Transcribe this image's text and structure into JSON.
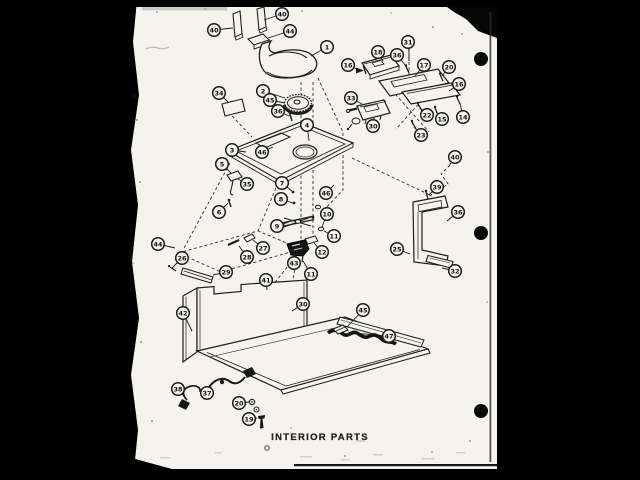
{
  "canvas": {
    "background_color": "#000000",
    "paper_color": "#f5f3ef",
    "ink_color": "#1c1c1c"
  },
  "diagram": {
    "title": "INTERIOR PARTS",
    "callouts": [
      {
        "n": "40",
        "x": 214,
        "y": 30,
        "tx": 233,
        "ty": 28
      },
      {
        "n": "40",
        "x": 282,
        "y": 14,
        "tx": 264,
        "ty": 20
      },
      {
        "n": "44",
        "x": 290,
        "y": 31,
        "tx": 268,
        "ty": 38
      },
      {
        "n": "1",
        "x": 327,
        "y": 47,
        "tx": 311,
        "ty": 56
      },
      {
        "n": "34",
        "x": 219,
        "y": 93,
        "tx": 228,
        "ty": 102
      },
      {
        "n": "2",
        "x": 263,
        "y": 91,
        "tx": 285,
        "ty": 98
      },
      {
        "n": "45",
        "x": 270,
        "y": 100,
        "tx": 285,
        "ty": 103
      },
      {
        "n": "36",
        "x": 278,
        "y": 111,
        "tx": 289,
        "ty": 116
      },
      {
        "n": "4",
        "x": 307,
        "y": 125,
        "tx": 309,
        "ty": 141
      },
      {
        "n": "3",
        "x": 232,
        "y": 150,
        "tx": 246,
        "ty": 152
      },
      {
        "n": "46",
        "x": 262,
        "y": 152,
        "tx": 273,
        "ty": 147
      },
      {
        "n": "5",
        "x": 222,
        "y": 164,
        "tx": 231,
        "ty": 173
      },
      {
        "n": "35",
        "x": 247,
        "y": 184,
        "tx": 238,
        "ty": 179
      },
      {
        "n": "6",
        "x": 219,
        "y": 212,
        "tx": 228,
        "ty": 203
      },
      {
        "n": "7",
        "x": 282,
        "y": 183,
        "tx": 292,
        "ty": 191
      },
      {
        "n": "8",
        "x": 281,
        "y": 199,
        "tx": 293,
        "ty": 203
      },
      {
        "n": "46",
        "x": 326,
        "y": 193,
        "tx": 334,
        "ty": 185
      },
      {
        "n": "9",
        "x": 277,
        "y": 226,
        "tx": 289,
        "ty": 222
      },
      {
        "n": "10",
        "x": 327,
        "y": 214,
        "tx": 322,
        "ty": 227
      },
      {
        "n": "11",
        "x": 334,
        "y": 236,
        "tx": 324,
        "ty": 231
      },
      {
        "n": "12",
        "x": 322,
        "y": 252,
        "tx": 314,
        "ty": 243
      },
      {
        "n": "43",
        "x": 294,
        "y": 263,
        "tx": 296,
        "ty": 257
      },
      {
        "n": "11",
        "x": 311,
        "y": 274,
        "tx": 303,
        "ty": 261
      },
      {
        "n": "44",
        "x": 158,
        "y": 244,
        "tx": 175,
        "ty": 248
      },
      {
        "n": "26",
        "x": 182,
        "y": 258,
        "tx": 172,
        "ty": 268
      },
      {
        "n": "27",
        "x": 263,
        "y": 248,
        "tx": 253,
        "ty": 240
      },
      {
        "n": "28",
        "x": 247,
        "y": 257,
        "tx": 239,
        "ty": 246
      },
      {
        "n": "29",
        "x": 226,
        "y": 272,
        "tx": 213,
        "ty": 275
      },
      {
        "n": "41",
        "x": 266,
        "y": 280,
        "tx": 267,
        "ty": 290
      },
      {
        "n": "42",
        "x": 183,
        "y": 313,
        "tx": 192,
        "ty": 331
      },
      {
        "n": "30",
        "x": 303,
        "y": 304,
        "tx": 292,
        "ty": 311
      },
      {
        "n": "45",
        "x": 363,
        "y": 310,
        "tx": 347,
        "ty": 327
      },
      {
        "n": "47",
        "x": 389,
        "y": 336,
        "tx": 352,
        "ty": 333
      },
      {
        "n": "38",
        "x": 178,
        "y": 389,
        "tx": 186,
        "ty": 399
      },
      {
        "n": "37",
        "x": 207,
        "y": 393,
        "tx": 211,
        "ty": 386
      },
      {
        "n": "20",
        "x": 239,
        "y": 403,
        "tx": 249,
        "ty": 402
      },
      {
        "n": "19",
        "x": 249,
        "y": 419,
        "tx": 257,
        "ty": 418
      },
      {
        "n": "16",
        "x": 348,
        "y": 65,
        "tx": 357,
        "ty": 69
      },
      {
        "n": "18",
        "x": 378,
        "y": 52,
        "tx": 383,
        "ty": 61
      },
      {
        "n": "31",
        "x": 408,
        "y": 42,
        "tx": 409,
        "ty": 52
      },
      {
        "n": "36",
        "x": 397,
        "y": 55,
        "tx": 406,
        "ty": 66
      },
      {
        "n": "17",
        "x": 424,
        "y": 65,
        "tx": 415,
        "ty": 76
      },
      {
        "n": "20",
        "x": 449,
        "y": 67,
        "tx": 442,
        "ty": 76
      },
      {
        "n": "16",
        "x": 459,
        "y": 84,
        "tx": 449,
        "ty": 91
      },
      {
        "n": "33",
        "x": 351,
        "y": 98,
        "tx": 362,
        "ty": 104
      },
      {
        "n": "30",
        "x": 373,
        "y": 126,
        "tx": 374,
        "ty": 119
      },
      {
        "n": "22",
        "x": 427,
        "y": 115,
        "tx": 420,
        "ty": 108
      },
      {
        "n": "15",
        "x": 442,
        "y": 119,
        "tx": 437,
        "ty": 113
      },
      {
        "n": "14",
        "x": 463,
        "y": 117,
        "tx": 460,
        "ty": 103
      },
      {
        "n": "23",
        "x": 421,
        "y": 135,
        "tx": 414,
        "ty": 127
      },
      {
        "n": "40",
        "x": 455,
        "y": 157,
        "tx": 449,
        "ty": 166
      },
      {
        "n": "39",
        "x": 437,
        "y": 187,
        "tx": 429,
        "ty": 195
      },
      {
        "n": "36",
        "x": 458,
        "y": 212,
        "tx": 447,
        "ty": 221
      },
      {
        "n": "25",
        "x": 397,
        "y": 249,
        "tx": 410,
        "ty": 254
      },
      {
        "n": "32",
        "x": 455,
        "y": 271,
        "tx": 442,
        "ty": 268
      }
    ]
  }
}
